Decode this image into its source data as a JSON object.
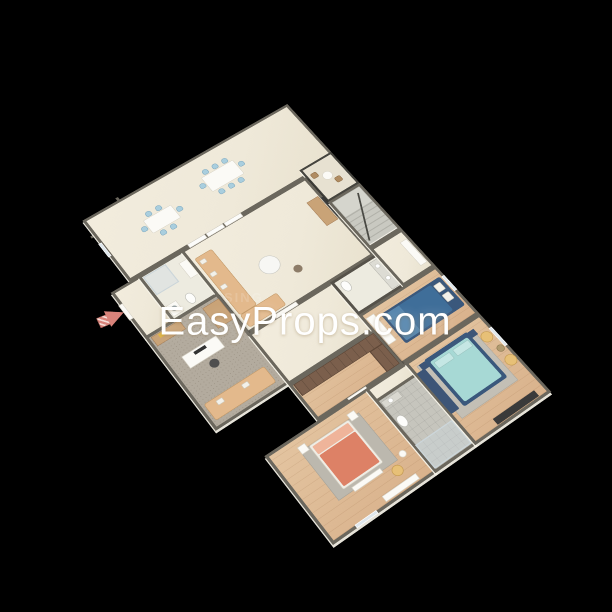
{
  "scene": {
    "type": "3d-rendered-floorplan",
    "background": "#000000",
    "description": "Isometric 3D dollhouse render of a multi-room apartment floor plan on a black background"
  },
  "watermark": {
    "text": "EasyProps.com",
    "faint_fragment": "SING"
  },
  "colors": {
    "bg": "#000000",
    "wall": "#6b675d",
    "floor_cream": "#efe9d9",
    "floor_wood": "#d9b28c",
    "floor_wood_light": "#e3c4a0",
    "carpet": "#b3ab9e",
    "tile": "#c6c5bd",
    "railing": "#46453f",
    "chair_blue": "#a9cede",
    "sofa_tan": "#e3b98c",
    "bed_coral": "#dd8166",
    "pillow_coral": "#efb49a",
    "bed_blue": "#3f6e99",
    "bed_navy_frame": "#3a587c",
    "bed_teal": "#a7d9d5",
    "pillow_teal": "#c5e7e4",
    "bench_navy": "#3d5577",
    "chair_yellow": "#e7c077",
    "wardrobe_brown": "#7b5f4c",
    "wood_cabinet": "#c9a377",
    "fixture_white": "#fdfdfb",
    "arrow_red": "#d9837a",
    "tv_dark": "#3a3a3a",
    "watermark": "#ffffff"
  },
  "rooms": [
    {
      "name": "dining-room",
      "furniture": [
        "dining-table-6-blue-chairs",
        "dining-table-8-blue-chairs",
        "window"
      ]
    },
    {
      "name": "balcony",
      "furniture": [
        "dark-railing",
        "round-table",
        "two-wood-chairs"
      ]
    },
    {
      "name": "entry",
      "furniture": [
        "entrance-door",
        "red-direction-arrow"
      ]
    },
    {
      "name": "bathroom-1",
      "furniture": [
        "shower",
        "washer",
        "toilet",
        "sink"
      ]
    },
    {
      "name": "living-room",
      "furniture": [
        "tan-l-sofa",
        "round-coffee-table",
        "pouf",
        "media-console",
        "tv",
        "sliding-panels"
      ]
    },
    {
      "name": "staircase",
      "furniture": [
        "grey-steps",
        "handrail"
      ]
    },
    {
      "name": "den-office",
      "furniture": [
        "grey-carpet",
        "sideboard",
        "cabinet",
        "desk-with-monitor",
        "office-chair",
        "tan-sofa"
      ]
    },
    {
      "name": "powder-room",
      "furniture": [
        "toilet",
        "double-sink-counter"
      ]
    },
    {
      "name": "bedroom-blue",
      "furniture": [
        "navy-double-bed",
        "white-dresser",
        "window"
      ]
    },
    {
      "name": "walk-in-closet",
      "furniture": [
        "brown-wardrobes"
      ]
    },
    {
      "name": "bedroom-coral",
      "furniture": [
        "coral-double-bed",
        "grey-rug",
        "two-nightstands",
        "yellow-armchair",
        "side-table",
        "low-console"
      ]
    },
    {
      "name": "bathroom-2",
      "furniture": [
        "sink-counter",
        "toilet",
        "shower"
      ]
    },
    {
      "name": "master-bedroom",
      "furniture": [
        "teal-bed-navy-frame",
        "grey-rug",
        "navy-bench",
        "two-yellow-armchairs",
        "side-table",
        "dark-tv-console"
      ]
    }
  ]
}
